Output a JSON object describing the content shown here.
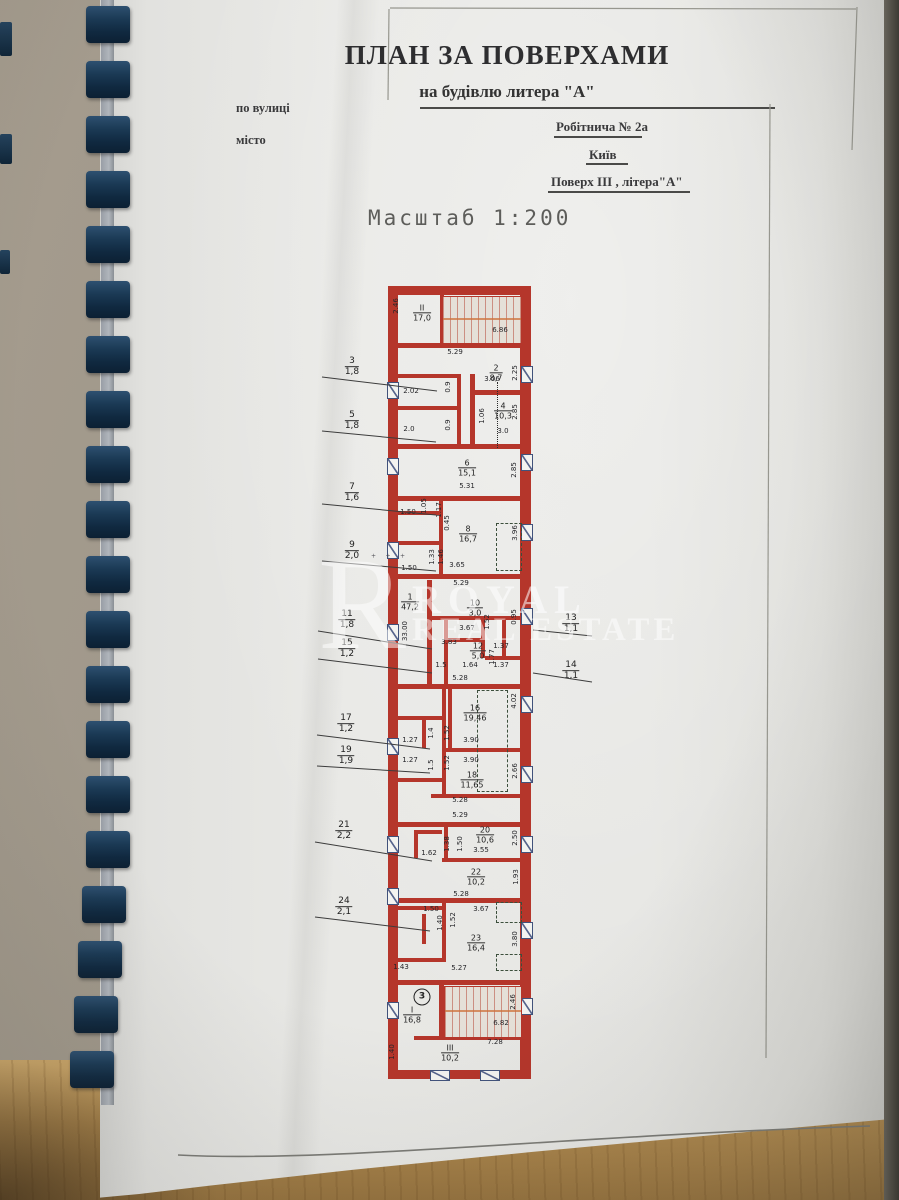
{
  "header": {
    "title": "ПЛАН  ЗА ПОВЕРХАМИ",
    "subtitle": "на  будівлю литера \"А\"",
    "street_label": "по вулиці",
    "city_label": "місто",
    "street_value": "Робітнича   № 2а",
    "city_value": "Київ",
    "floor_value": "Поверх ІІІ , літера\"А\"",
    "scale": "Масштаб 1:200"
  },
  "watermark": {
    "letter": "R",
    "line1": "ROYAL",
    "line2": "REAL ESTATE"
  },
  "binding": {
    "teeth_count": 20,
    "edge_marks": [
      [
        0,
        22,
        12,
        34
      ],
      [
        0,
        134,
        12,
        30
      ],
      [
        0,
        250,
        10,
        24
      ]
    ]
  },
  "page": {
    "frame_lines": [
      [
        390,
        8,
        856,
        9
      ],
      [
        389,
        9,
        388,
        100
      ],
      [
        857,
        7,
        852,
        150
      ],
      [
        770,
        104,
        766,
        1058
      ]
    ],
    "bottom_curve": "M178,1155 C330,1163 560,1136 870,1126",
    "marks": [
      {
        "t": "+ + +",
        "x": 390,
        "y": 556
      }
    ]
  },
  "plan": {
    "wall_color": "#b5362b",
    "walls": [
      [
        4,
        0,
        143,
        9
      ],
      [
        4,
        0,
        10,
        788
      ],
      [
        136,
        0,
        11,
        793
      ],
      [
        4,
        784,
        143,
        9
      ],
      [
        13,
        57,
        124,
        5
      ],
      [
        56,
        9,
        4,
        48
      ],
      [
        13,
        88,
        64,
        4
      ],
      [
        13,
        120,
        64,
        4
      ],
      [
        13,
        158,
        124,
        5
      ],
      [
        73,
        88,
        4,
        72
      ],
      [
        86,
        88,
        5,
        72
      ],
      [
        86,
        104,
        51,
        5
      ],
      [
        13,
        210,
        124,
        5
      ],
      [
        13,
        225,
        44,
        4
      ],
      [
        13,
        255,
        44,
        4
      ],
      [
        55,
        210,
        4,
        78
      ],
      [
        13,
        288,
        124,
        5
      ],
      [
        47,
        330,
        90,
        4
      ],
      [
        43,
        294,
        5,
        104
      ],
      [
        60,
        330,
        4,
        68
      ],
      [
        64,
        352,
        33,
        4
      ],
      [
        97,
        330,
        4,
        42
      ],
      [
        101,
        370,
        36,
        4
      ],
      [
        118,
        334,
        4,
        36
      ],
      [
        13,
        398,
        124,
        5
      ],
      [
        58,
        398,
        4,
        110
      ],
      [
        64,
        402,
        4,
        60
      ],
      [
        13,
        430,
        45,
        4
      ],
      [
        38,
        430,
        4,
        32
      ],
      [
        58,
        462,
        79,
        4
      ],
      [
        13,
        492,
        45,
        4
      ],
      [
        47,
        508,
        90,
        4
      ],
      [
        13,
        536,
        124,
        5
      ],
      [
        60,
        536,
        4,
        40
      ],
      [
        30,
        544,
        28,
        4
      ],
      [
        30,
        544,
        4,
        28
      ],
      [
        58,
        572,
        79,
        4
      ],
      [
        13,
        612,
        124,
        5
      ],
      [
        58,
        612,
        4,
        64
      ],
      [
        13,
        620,
        45,
        4
      ],
      [
        38,
        628,
        4,
        30
      ],
      [
        13,
        672,
        47,
        4
      ],
      [
        13,
        694,
        124,
        5
      ],
      [
        55,
        694,
        5,
        60
      ],
      [
        30,
        750,
        107,
        4
      ]
    ],
    "windows": [
      {
        "x": 3,
        "y": 96,
        "w": 10,
        "h": 15
      },
      {
        "x": 3,
        "y": 172,
        "w": 10,
        "h": 15
      },
      {
        "x": 3,
        "y": 256,
        "w": 10,
        "h": 15
      },
      {
        "x": 3,
        "y": 338,
        "w": 10,
        "h": 15
      },
      {
        "x": 3,
        "y": 452,
        "w": 10,
        "h": 15
      },
      {
        "x": 3,
        "y": 550,
        "w": 10,
        "h": 15
      },
      {
        "x": 3,
        "y": 602,
        "w": 10,
        "h": 15
      },
      {
        "x": 3,
        "y": 716,
        "w": 10,
        "h": 15
      },
      {
        "x": 137,
        "y": 80,
        "w": 10,
        "h": 15
      },
      {
        "x": 137,
        "y": 168,
        "w": 10,
        "h": 15
      },
      {
        "x": 137,
        "y": 238,
        "w": 10,
        "h": 15
      },
      {
        "x": 137,
        "y": 322,
        "w": 10,
        "h": 15
      },
      {
        "x": 137,
        "y": 410,
        "w": 10,
        "h": 15
      },
      {
        "x": 137,
        "y": 480,
        "w": 10,
        "h": 15
      },
      {
        "x": 137,
        "y": 550,
        "w": 10,
        "h": 15
      },
      {
        "x": 137,
        "y": 636,
        "w": 10,
        "h": 15
      },
      {
        "x": 137,
        "y": 712,
        "w": 10,
        "h": 15
      },
      {
        "x": 46,
        "y": 784,
        "w": 18,
        "h": 9
      },
      {
        "x": 96,
        "y": 784,
        "w": 18,
        "h": 9
      }
    ],
    "stairs": [
      {
        "x": 58,
        "y": 10,
        "w": 78,
        "h": 46
      },
      {
        "x": 60,
        "y": 700,
        "w": 76,
        "h": 50
      }
    ],
    "dashes": [
      {
        "x": 112,
        "y": 237,
        "w": 24,
        "h": 46
      },
      {
        "x": 93,
        "y": 404,
        "w": 29,
        "h": 100
      },
      {
        "x": 112,
        "y": 616,
        "w": 24,
        "h": 19
      },
      {
        "x": 112,
        "y": 668,
        "w": 24,
        "h": 15
      }
    ],
    "dotted": [
      {
        "x": 113,
        "y": 96,
        "h": 66
      }
    ],
    "rooms": [
      {
        "n": "ІІ",
        "a": "17,0",
        "x": 38,
        "y": 27
      },
      {
        "n": "2",
        "a": "8,7",
        "x": 112,
        "y": 87
      },
      {
        "n": "4",
        "a": "10,3",
        "x": 119,
        "y": 125
      },
      {
        "n": "6",
        "a": "15,1",
        "x": 83,
        "y": 182
      },
      {
        "n": "8",
        "a": "16,7",
        "x": 84,
        "y": 248
      },
      {
        "n": "1",
        "a": "47,2",
        "x": 26,
        "y": 316
      },
      {
        "n": "10",
        "a": "3,0",
        "x": 91,
        "y": 322
      },
      {
        "n": "12",
        "a": "5,0",
        "x": 94,
        "y": 365
      },
      {
        "n": "16",
        "a": "19,46",
        "x": 91,
        "y": 427
      },
      {
        "n": "18",
        "a": "11,65",
        "x": 88,
        "y": 494
      },
      {
        "n": "20",
        "a": "10,6",
        "x": 101,
        "y": 549
      },
      {
        "n": "22",
        "a": "10,2",
        "x": 92,
        "y": 591
      },
      {
        "n": "23",
        "a": "16,4",
        "x": 92,
        "y": 657
      },
      {
        "n": "І",
        "a": "16,8",
        "x": 28,
        "y": 729
      },
      {
        "n": "ІІІ",
        "a": "10,2",
        "x": 66,
        "y": 767
      }
    ],
    "circled_stair_number": {
      "t": "3",
      "x": 38,
      "y": 711
    },
    "dims_h": [
      {
        "t": "6.86",
        "x": 116,
        "y": 44
      },
      {
        "t": "5.29",
        "x": 71,
        "y": 66
      },
      {
        "t": "3.06",
        "x": 108,
        "y": 93
      },
      {
        "t": "2.02",
        "x": 27,
        "y": 105
      },
      {
        "t": "2.0",
        "x": 25,
        "y": 143
      },
      {
        "t": "3.0",
        "x": 119,
        "y": 145
      },
      {
        "t": "5.31",
        "x": 83,
        "y": 200
      },
      {
        "t": "1.50",
        "x": 24,
        "y": 226
      },
      {
        "t": "3.65",
        "x": 73,
        "y": 279
      },
      {
        "t": "1.50",
        "x": 25,
        "y": 282
      },
      {
        "t": "5.29",
        "x": 77,
        "y": 297
      },
      {
        "t": "3.67",
        "x": 83,
        "y": 342
      },
      {
        "t": "3.83",
        "x": 65,
        "y": 356
      },
      {
        "t": "1.37",
        "x": 117,
        "y": 360
      },
      {
        "t": "1.5",
        "x": 57,
        "y": 379
      },
      {
        "t": "1.64",
        "x": 86,
        "y": 379
      },
      {
        "t": "1.37",
        "x": 117,
        "y": 379
      },
      {
        "t": "5.28",
        "x": 76,
        "y": 392
      },
      {
        "t": "1.27",
        "x": 26,
        "y": 454
      },
      {
        "t": "3.90",
        "x": 87,
        "y": 454
      },
      {
        "t": "1.27",
        "x": 26,
        "y": 474
      },
      {
        "t": "3.90",
        "x": 87,
        "y": 474
      },
      {
        "t": "5.28",
        "x": 76,
        "y": 514
      },
      {
        "t": "5.29",
        "x": 76,
        "y": 529
      },
      {
        "t": "1.62",
        "x": 45,
        "y": 567
      },
      {
        "t": "3.55",
        "x": 97,
        "y": 564
      },
      {
        "t": "5.28",
        "x": 77,
        "y": 608
      },
      {
        "t": "1.50",
        "x": 47,
        "y": 623
      },
      {
        "t": "3.67",
        "x": 97,
        "y": 623
      },
      {
        "t": "1.43",
        "x": 17,
        "y": 681
      },
      {
        "t": "5.27",
        "x": 75,
        "y": 682
      },
      {
        "t": "6.82",
        "x": 117,
        "y": 737
      },
      {
        "t": "7.28",
        "x": 111,
        "y": 756
      }
    ],
    "dims_v": [
      {
        "t": "2.46",
        "x": 12,
        "y": 20
      },
      {
        "t": "2.25",
        "x": 131,
        "y": 87
      },
      {
        "t": "0.9",
        "x": 64,
        "y": 101
      },
      {
        "t": "2.85",
        "x": 131,
        "y": 126
      },
      {
        "t": "1.06",
        "x": 98,
        "y": 130
      },
      {
        "t": "0.9",
        "x": 64,
        "y": 139
      },
      {
        "t": "2.85",
        "x": 130,
        "y": 184
      },
      {
        "t": "1.05",
        "x": 40,
        "y": 220
      },
      {
        "t": "1.17",
        "x": 55,
        "y": 224
      },
      {
        "t": "0.45",
        "x": 63,
        "y": 237
      },
      {
        "t": "1.33",
        "x": 48,
        "y": 271
      },
      {
        "t": "1.46",
        "x": 57,
        "y": 271
      },
      {
        "t": "3.96",
        "x": 131,
        "y": 247
      },
      {
        "t": "33.00",
        "x": 21,
        "y": 345
      },
      {
        "t": "1.52",
        "x": 103,
        "y": 336
      },
      {
        "t": "0.95",
        "x": 130,
        "y": 331
      },
      {
        "t": "1.77",
        "x": 108,
        "y": 371
      },
      {
        "t": "4.02",
        "x": 130,
        "y": 415
      },
      {
        "t": "1.4",
        "x": 47,
        "y": 447
      },
      {
        "t": "1.52",
        "x": 63,
        "y": 447
      },
      {
        "t": "1.5",
        "x": 47,
        "y": 479
      },
      {
        "t": "1.52",
        "x": 63,
        "y": 477
      },
      {
        "t": "2.66",
        "x": 131,
        "y": 485
      },
      {
        "t": "1.38",
        "x": 63,
        "y": 558
      },
      {
        "t": "1.50",
        "x": 76,
        "y": 558
      },
      {
        "t": "2.50",
        "x": 131,
        "y": 552
      },
      {
        "t": "1.93",
        "x": 132,
        "y": 591
      },
      {
        "t": "1.40",
        "x": 56,
        "y": 637
      },
      {
        "t": "1.52",
        "x": 69,
        "y": 634
      },
      {
        "t": "3.80",
        "x": 131,
        "y": 653
      },
      {
        "t": "2.46",
        "x": 129,
        "y": 716
      },
      {
        "t": "1.40",
        "x": 8,
        "y": 766
      }
    ],
    "leaders_left": [
      {
        "n": "3",
        "a": "1,8",
        "x": 352,
        "y": 367,
        "line": [
          322,
          377,
          437,
          391
        ]
      },
      {
        "n": "5",
        "a": "1,8",
        "x": 352,
        "y": 421,
        "line": [
          322,
          431,
          436,
          442
        ]
      },
      {
        "n": "7",
        "a": "1,6",
        "x": 352,
        "y": 493,
        "line": [
          322,
          504,
          436,
          515
        ]
      },
      {
        "n": "9",
        "a": "2,0",
        "x": 352,
        "y": 551,
        "line": [
          322,
          561,
          436,
          571
        ]
      },
      {
        "n": "11",
        "a": "1,8",
        "x": 347,
        "y": 620,
        "line": [
          318,
          631,
          432,
          649
        ]
      },
      {
        "n": "15",
        "a": "1,2",
        "x": 347,
        "y": 649,
        "line": [
          318,
          659,
          432,
          673
        ]
      },
      {
        "n": "17",
        "a": "1,2",
        "x": 346,
        "y": 724,
        "line": [
          317,
          735,
          430,
          749
        ]
      },
      {
        "n": "19",
        "a": "1,9",
        "x": 346,
        "y": 756,
        "line": [
          317,
          766,
          430,
          773
        ]
      },
      {
        "n": "21",
        "a": "2,2",
        "x": 344,
        "y": 831,
        "line": [
          315,
          842,
          432,
          861
        ]
      },
      {
        "n": "24",
        "a": "2,1",
        "x": 344,
        "y": 907,
        "line": [
          315,
          917,
          430,
          931
        ]
      }
    ],
    "leaders_right": [
      {
        "n": "13",
        "a": "1,1",
        "x": 571,
        "y": 624,
        "line": [
          533,
          630,
          592,
          636
        ]
      },
      {
        "n": "14",
        "a": "1,1",
        "x": 571,
        "y": 671,
        "line": [
          533,
          673,
          592,
          682
        ]
      }
    ]
  }
}
